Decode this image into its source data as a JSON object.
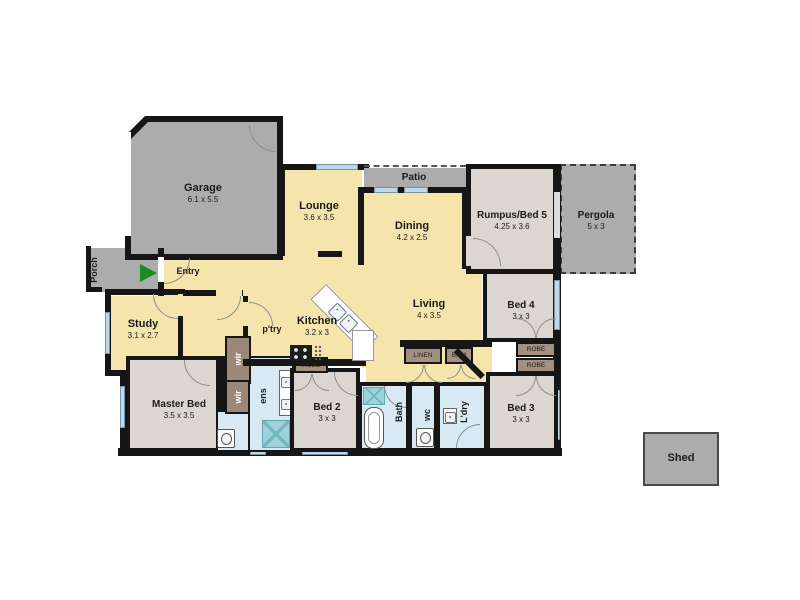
{
  "rooms": {
    "porch": {
      "name": "Porch"
    },
    "garage": {
      "name": "Garage",
      "dims": "6.1 x 5.5"
    },
    "entry": {
      "name": "Entry"
    },
    "lounge": {
      "name": "Lounge",
      "dims": "3.6 x 3.5"
    },
    "patio": {
      "name": "Patio"
    },
    "dining": {
      "name": "Dining",
      "dims": "4.2 x 2.5"
    },
    "rumpus": {
      "name": "Rumpus/Bed 5",
      "dims": "4.25 x 3.6"
    },
    "pergola": {
      "name": "Pergola",
      "dims": "5 x 3"
    },
    "living": {
      "name": "Living",
      "dims": "4 x 3.5"
    },
    "bed4": {
      "name": "Bed 4",
      "dims": "3 x 3"
    },
    "study": {
      "name": "Study",
      "dims": "3.1 x 2.7"
    },
    "kitchen": {
      "name": "Kitchen",
      "dims": "3.2 x 3"
    },
    "pantry": {
      "name": "p'try"
    },
    "master": {
      "name": "Master Bed",
      "dims": "3.5 x 3.5"
    },
    "wir_upper": {
      "name": "wir"
    },
    "wir_lower": {
      "name": "wir"
    },
    "ens": {
      "name": "ens"
    },
    "bed2": {
      "name": "Bed 2",
      "dims": "3 x 3"
    },
    "bath": {
      "name": "Bath"
    },
    "wc": {
      "name": "wc"
    },
    "laundry": {
      "name": "L'dry"
    },
    "bed3": {
      "name": "Bed 3",
      "dims": "3 x 3"
    },
    "linen": {
      "name": "LINEN"
    },
    "brm": {
      "name": "BRM"
    },
    "robe_bed2": {
      "name": "ROBE"
    },
    "robe_bed4": {
      "name": "ROBE"
    },
    "robe_bed3": {
      "name": "ROBE"
    },
    "shed": {
      "name": "Shed"
    }
  },
  "colors": {
    "wall": "#161616",
    "interior_yellow": "#F5E5AD",
    "outdoor_gray": "#ACACAC",
    "bedroom_beige": "#DCD6D0",
    "wet_area_blue": "#D9E9F3",
    "window_blue": "#BCD8E9",
    "robe_brown": "#A39180",
    "wir_brown": "#9B8878",
    "shower_teal": "#9ED2D8",
    "entry_arrow_green": "#1E8A22"
  }
}
